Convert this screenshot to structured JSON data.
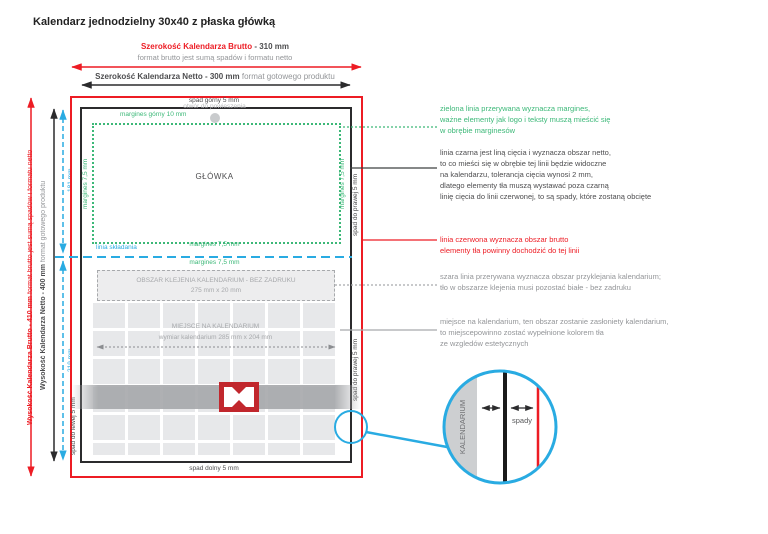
{
  "title": "Kalendarz jednodzielny 30x40 z płaska główką",
  "colors": {
    "red": "#ed1c24",
    "green": "#3cb878",
    "blue": "#29abe2",
    "gray": "#939598",
    "marker_red": "#c1272d"
  },
  "top_dimensions": {
    "brutto_label": "Szerokość Kalendarza Brutto",
    "brutto_value": " - 310 mm",
    "brutto_note": "format brutto jest sumą spadów i formatu netto",
    "netto_label": "Szerokość Kalendarza Netto - 300 mm",
    "netto_note": " format gotowego produktu"
  },
  "left_dimensions": {
    "brutto_label": "Wysokość Kalendarza Brutto - 410 mm",
    "brutto_note": " format brutto jest sumą spadów i formatu netto",
    "netto_label": "Wysokość Kalendarza Netto - 400 mm",
    "netto_note": " format gotowego produktu",
    "upper_section": "181 mm",
    "lower_section": "219 mm"
  },
  "diagram": {
    "bleed_top": "spad górny 5 mm",
    "bleed_bottom": "spad dolny 5 mm",
    "bleed_left": "spad do lewej 5 mm",
    "bleed_right_upper": "spad do prawej 5 mm",
    "bleed_right_lower": "spad do prawej 5 mm",
    "margin_top": "margines górny 10 mm",
    "margin_left": "margines 7,5 mm",
    "margin_right": "margines 7,5 mm",
    "hole_label": "otwór do powieszenia",
    "header_label": "GŁÓWKA",
    "fold_label": "linia składania",
    "margin_above_fold": "margines 7,5 mm",
    "margin_below_fold": "margines 7,5 mm",
    "glue_line1": "OBSZAR KLEJENIA KALENDARIUM - BEZ ZADRUKU",
    "glue_line2": "275 mm x 20 mm",
    "calendar_area": "MIEJSCE NA KALENDARIUM\nwymiar kalendarium 285 mm x 204 mm"
  },
  "notes": {
    "green": "zielona linia przerywana wyznacza margines,\nważne elementy jak logo i teksty muszą mieścić się\nw obrębie marginesów",
    "black": "linia czarna jest liną cięcia i wyznacza obszar netto,\nto co mieści się w obrębie tej linii będzie widoczne\nna kalendarzu, tolerancja cięcia wynosi 2 mm,\ndlatego elementy tła muszą wystawać poza czarną\nlinię cięcia do linii czerwonej, to są spady, które zostaną obcięte",
    "red": "linia czerwona wyznacza obszar brutto\nelementy tła powinny dochodzić do tej linii",
    "gray_glue": "szara linia przerywana wyznacza obszar przyklejania kalendarium;\ntło w obszarze klejenia musi pozostać białe - bez zadruku",
    "gray_calendar": "miejsce na kalendarium, ten obszar zostanie zasłoniety kalendarium,\nto miejscepowinno zostać wypełnione kolorem tła\nze wzgledów estetycznych"
  },
  "zoom_detail": {
    "band_label": "KALENDARIUM",
    "arrows_label": "spady"
  }
}
